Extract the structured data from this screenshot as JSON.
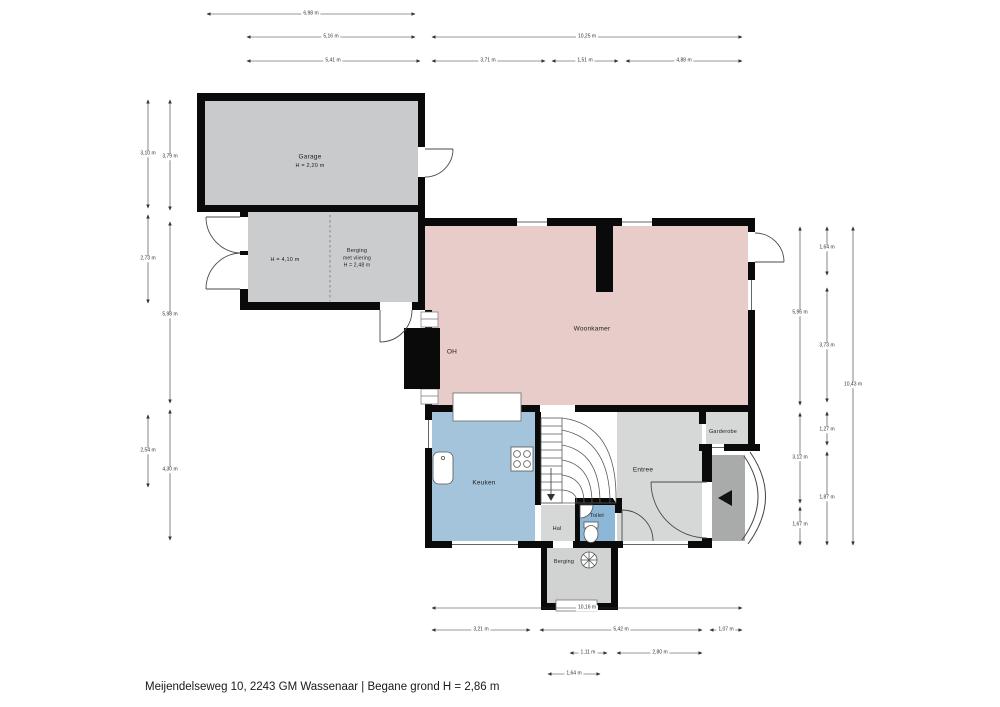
{
  "footer": {
    "title": "Meijendelseweg 10, 2243 GM Wassenaar | Begane grond H = 2,86 m"
  },
  "rooms": {
    "garage": {
      "name": "Garage",
      "height": "H = 2,20 m"
    },
    "berging_attic": {
      "height_left": "H = 4,10 m",
      "name": "Berging",
      "sub": "met vliering",
      "height": "H = 2,48 m"
    },
    "woonkamer": {
      "name": "Woonkamer"
    },
    "fireplace": {
      "name": "OH"
    },
    "keuken": {
      "name": "Keuken"
    },
    "hal": {
      "name": "Hal"
    },
    "toilet": {
      "name": "Toilet"
    },
    "entree": {
      "name": "Entree"
    },
    "garderobe": {
      "name": "Garderobe"
    },
    "berging_small": {
      "name": "Berging"
    }
  },
  "dimensions": {
    "top": [
      "6,98 m",
      "5,16 m",
      "10,25 m",
      "5,41 m",
      "3,71 m",
      "1,51 m",
      "4,88 m"
    ],
    "left": [
      "3,10 m",
      "3,79 m",
      "2,73 m",
      "5,98 m",
      "2,54 m",
      "4,30 m"
    ],
    "right": [
      "5,96 m",
      "1,64 m",
      "10,43 m",
      "3,73 m",
      "3,12 m",
      "1,27 m",
      "1,87 m",
      "1,67 m"
    ],
    "bottom": [
      "10,16 m",
      "3,21 m",
      "5,42 m",
      "1,07 m",
      "1,11 m",
      "2,80 m",
      "1,64 m"
    ]
  },
  "colors": {
    "wall": "#0a0a0a",
    "garage": "#c9cacb",
    "berging": "#cbcccd",
    "woonkamer": "#e8ccc9",
    "keuken": "#a4c4dc",
    "toilet": "#8db7d6",
    "entree": "#d5d8d6",
    "hal": "#d5d8d6",
    "garderobe": "#d5d8d6",
    "berging_small": "#d0d3d2",
    "porch": "#a9abaa"
  }
}
